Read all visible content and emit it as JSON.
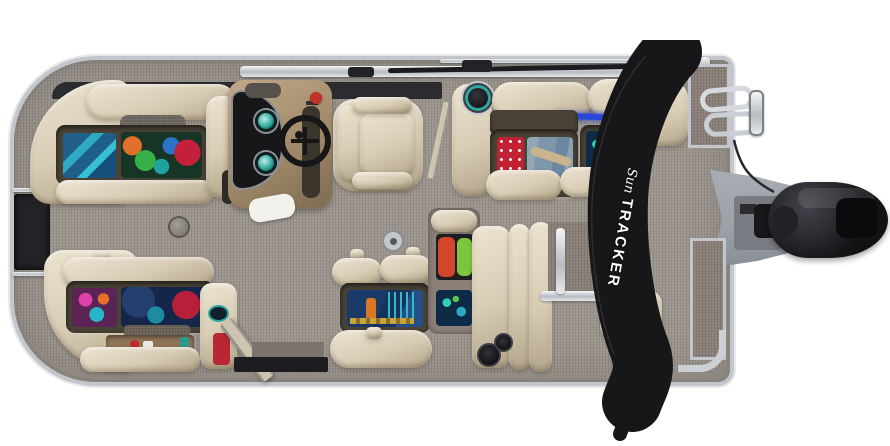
{
  "scene": {
    "type": "product-photograph",
    "description": "Top-down overhead view of a SUN TRACKER pontoon boat on a white background: beige vinyl lounge seats with open under-seat storage compartments full of colorful towels and life vests, tan helm console with steering wheel and teal gauges, beige captain's swivel chair, gray woven deck flooring with table-mount deck plates, folded black bimini top with Sun Tracker logo laid across the stern, stern fence panels, folded boarding ladder, gray splash platform and black outboard motor.",
    "background_color": "#ffffff"
  },
  "branding": {
    "bimini_logo_script": "Sun",
    "bimini_logo_block": "TRACKER"
  },
  "colors": {
    "background": "#ffffff",
    "floor": "#9c968e",
    "upholstery": "#d8ccb4",
    "upholstery_hi": "#ece3d0",
    "upholstery_sh": "#b1a489",
    "storage_frame": "#4a4337",
    "console_tan": "#a18a6a",
    "chrome": "#c6cad0",
    "bimini_black": "#17171a",
    "panel_taupe": "#8a8078",
    "platform_gray": "#99a0a7",
    "gauge_teal": "#2fa89e",
    "throttle_red": "#c23127",
    "motor_black": "#131316",
    "led_blue": "#2948d8",
    "towel_red": "#c12233",
    "denim_blue": "#7e96aa",
    "vest_red": "#d2472c",
    "vest_green": "#7ec43e",
    "navy_gear": "#14264a"
  }
}
